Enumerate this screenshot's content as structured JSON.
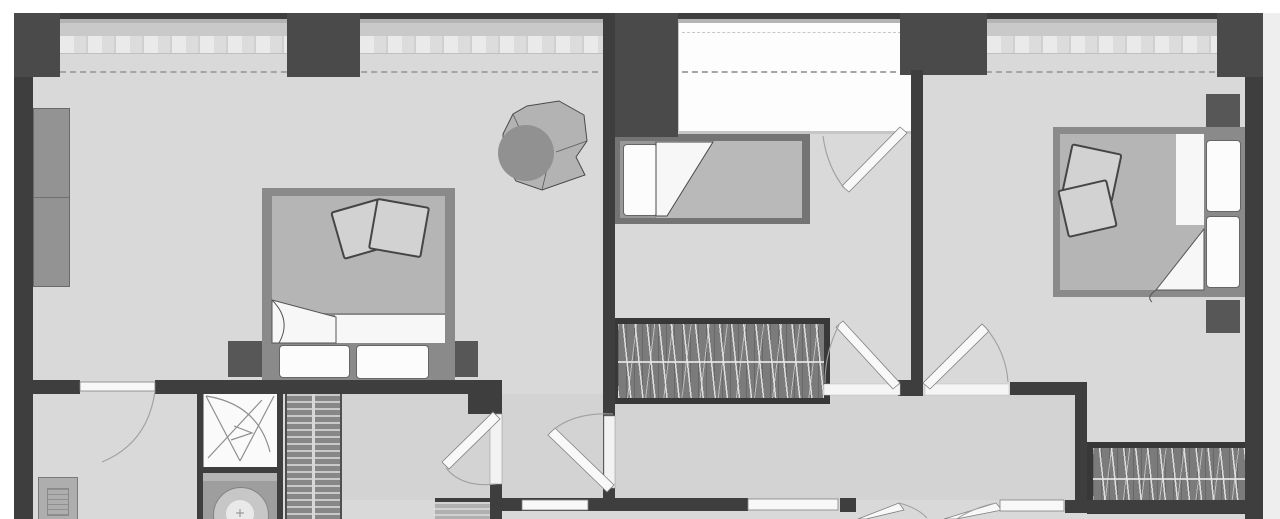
{
  "scene": {
    "type": "apartment-floor-plan",
    "view": "top-down",
    "style": "grayscale-architectural-render",
    "rooms": [
      "bedroom-left",
      "bedroom-middle",
      "bedroom-right",
      "bathroom",
      "hallway",
      "storage-room-bottom-left",
      "loggia-balcony"
    ],
    "furniture": [
      "double-bed-left",
      "single-bed-middle",
      "double-bed-right",
      "round-armchair-with-throw",
      "nightstands",
      "wardrobe-middle-room",
      "wardrobe-right-room",
      "hall-closet-shelves",
      "left-wall-cabinet",
      "shower-cabin",
      "washing-machine",
      "entrance-door",
      "small-shelf"
    ],
    "doors_with_swing_arcs": 9,
    "windows": [
      "left-band-a",
      "left-band-b",
      "loggia-opening",
      "right-band"
    ]
  },
  "palette": {
    "outside": "#ffffff",
    "outside_right": "#eeeeee",
    "wall": "#3e3e3e",
    "wall_soft": "#4a4a4a",
    "floor": "#d9d9d9",
    "hall_floor": "#d3d3d3",
    "sill": "#c9c9c9",
    "tile_light": "#eaeaea",
    "tile_mid": "#dcdcdc",
    "tile_dark": "#d0d0d0",
    "loggia": "#fdfdfd",
    "dashed": "#a5a5a5",
    "bed_frame": "#8a8a8a",
    "bed_frame_dark": "#747474",
    "duvet": "#b5b5b5",
    "mattress": "#b9b9b9",
    "sheet": "#f7f7f7",
    "pillow": "#fcfcfc",
    "pillow_edge": "#666666",
    "cushion": "#d2d2d2",
    "cushion_edge": "#454545",
    "nightstand": "#575757",
    "wardrobe_bg": "#7b7b7b",
    "wardrobe_frame": "#383838",
    "closet_stripe_dark": "#878787",
    "closet_stripe_light": "#c9c9c9",
    "shelf_small": "#b0b0b0",
    "left_wardrobe": "#939393",
    "door_leaf": "#f8f8f8",
    "door_edge": "#808080",
    "arc": "#a0a0a0",
    "threshold": "#f5f5f5",
    "shower_bg": "#fafafa",
    "shower_line": "#8e8e8e",
    "washer_body": "#9e9e9e",
    "washer_top": "#b5b5b5",
    "drum": "#c7c7c7",
    "drum_inner": "#e9e9e9",
    "armchair": "#919191",
    "blanket": "#b3b3b3",
    "blanket_edge": "#4a4a4a",
    "entry_door": "#aeaeae"
  }
}
